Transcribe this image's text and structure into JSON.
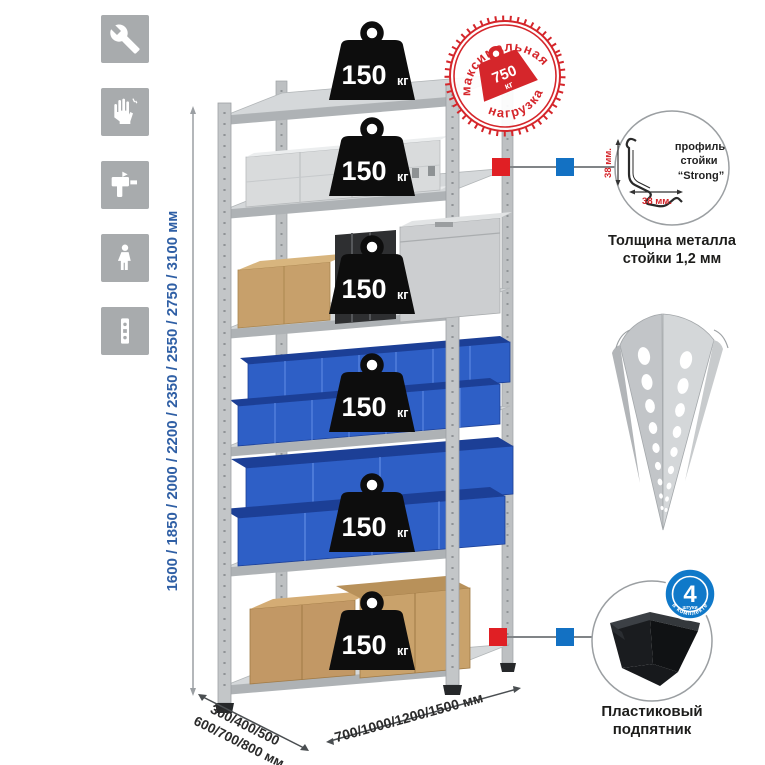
{
  "colors": {
    "accent_red": "#d5262b",
    "marker_red": "#e01f24",
    "marker_blue": "#1371c3",
    "badge_blue": "#1079c9",
    "dim_text_blue": "#2f5fa5",
    "metal_gray": "#c3c6c8",
    "bin_blue": "#2e5fc6",
    "icon_square_gray": "#a8abad"
  },
  "left_icons": {
    "items": [
      {
        "name": "wrench-icon"
      },
      {
        "name": "gloves-icon"
      },
      {
        "name": "drill-icon"
      },
      {
        "name": "person-icon"
      },
      {
        "name": "upright-profile-icon"
      }
    ]
  },
  "dimensions": {
    "height_label": "1600 / 1850 / 2000 / 2200 / 2350 / 2550 / 2750 / 3100 мм",
    "depth_label_line1": "300/400/500",
    "depth_label_line2": "600/700/800 мм",
    "width_label": "700/1000/1200/1500 мм"
  },
  "rack": {
    "shelf_count": 6,
    "shelf_load_value": "150",
    "shelf_load_unit": "кг"
  },
  "max_load_stamp": {
    "top_text": "максимальная",
    "bottom_text": "нагрузка",
    "value": "750",
    "unit": "кг"
  },
  "profile_callout": {
    "label_line1": "профиль",
    "label_line2": "стойки",
    "label_line3": "“Strong”",
    "dim_vertical": "38 мм.",
    "dim_horizontal": "38 мм.",
    "caption_line1": "Толщина металла",
    "caption_line2": "стойки 1,2 мм"
  },
  "foot_callout": {
    "badge_value": "4",
    "badge_small_text": "штуки",
    "badge_arc_text": "в комплекте",
    "caption_line1": "Пластиковый",
    "caption_line2": "подпятник"
  }
}
